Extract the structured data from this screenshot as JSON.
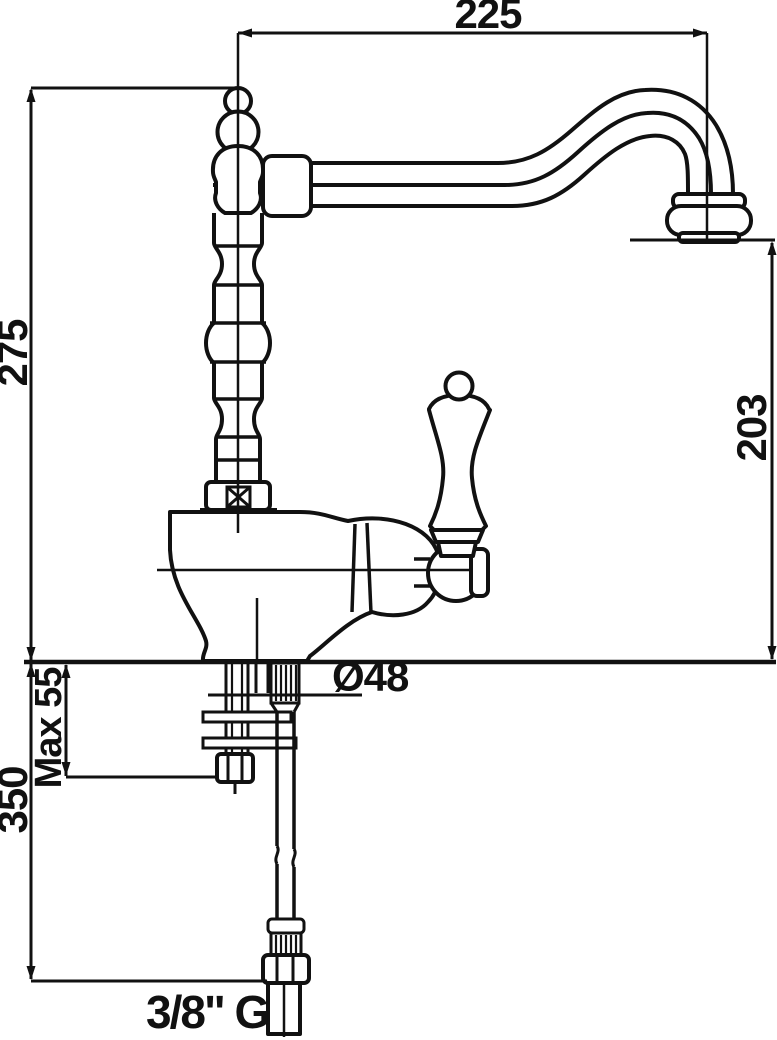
{
  "page": {
    "background_color": "#ffffff",
    "ink_color": "#111111"
  },
  "drawing": {
    "type": "technical-dimension-drawing",
    "subject": "single-lever kitchen mixer tap, side elevation with installation dimensions",
    "units": "mm",
    "labels": {
      "spout_reach": "225",
      "height_above_deck": "275",
      "outlet_height": "203",
      "base_diameter": "Ø48",
      "max_deck_thickness": "Max 55",
      "supply_hose_length": "350",
      "supply_thread": "3/8\" G"
    }
  }
}
